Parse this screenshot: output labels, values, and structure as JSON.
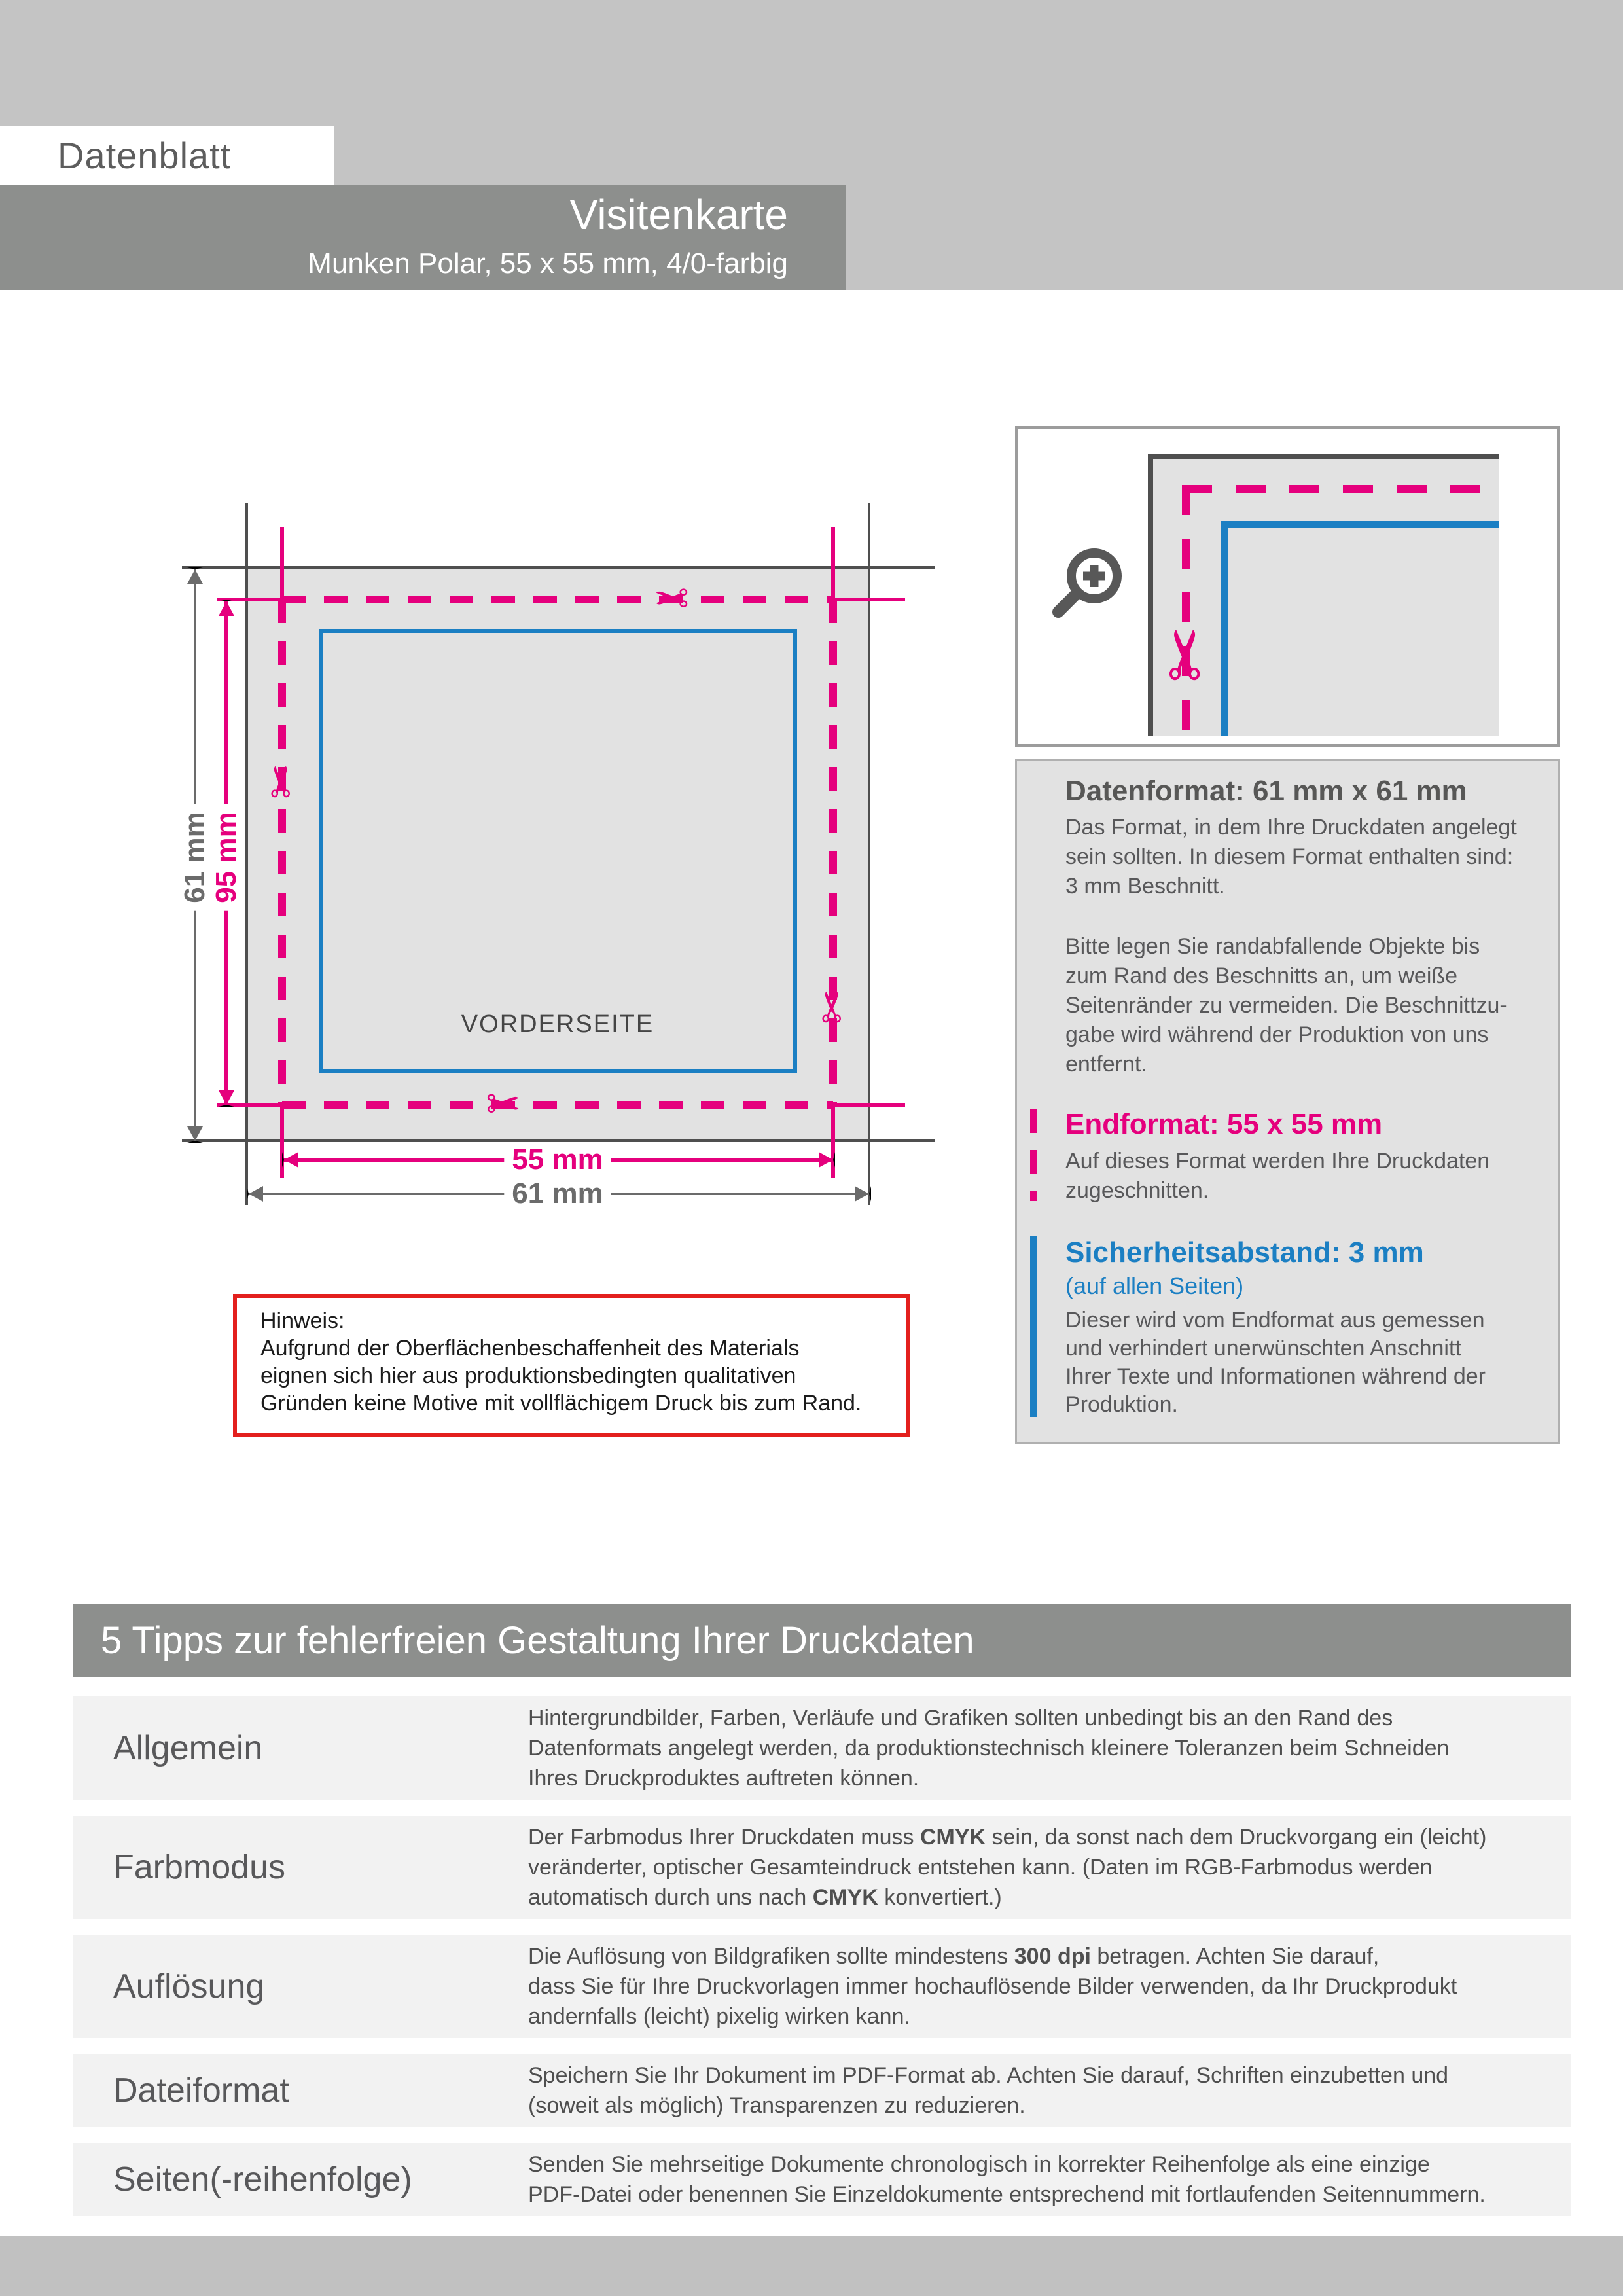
{
  "colors": {
    "magenta": "#e5007d",
    "blue": "#1b7fc3",
    "red": "#e3201d",
    "dark": "#575756",
    "band": "#8d8f8d",
    "light": "#c4c4c4",
    "fill": "#e2e2e2",
    "row": "#f2f2f2",
    "footer": "#c1c1c1",
    "cropline": "#4f4f4f"
  },
  "icons": {
    "scissors": "✂"
  },
  "header": {
    "tag": "Datenblatt",
    "product": "Visitenkarte",
    "specs": "Munken Polar, 55 x 55 mm, 4/0-farbig"
  },
  "diagram": {
    "front_label": "VORDERSEITE",
    "dim_outer_vertical": "61 mm",
    "dim_inner_vertical": "95 mm",
    "dim_inner_horizontal": "55 mm",
    "dim_outer_horizontal": "61 mm"
  },
  "panel": {
    "datenformat": {
      "heading": "Datenformat: 61 mm x 61 mm",
      "body1": "Das Format, in dem Ihre Druckdaten angelegt\nsein sollten. In diesem Format enthalten sind:\n3 mm Beschnitt.",
      "body2": "Bitte legen Sie randabfallende Objekte bis\nzum Rand des Beschnitts an, um weiße\nSeitenränder zu vermeiden. Die Beschnittzu-\ngabe wird während der Produktion von uns\nentfernt."
    },
    "endformat": {
      "heading": "Endformat: 55 x 55 mm",
      "body": "Auf dieses Format werden Ihre Druckdaten\nzugeschnitten."
    },
    "sicherheitsabstand": {
      "heading": "Sicherheitsabstand: 3 mm",
      "subheading": "(auf allen Seiten)",
      "body": "Dieser wird vom Endformat aus gemessen\nund verhindert unerwünschten Anschnitt\nIhrer Texte und Informationen während der\nProduktion."
    }
  },
  "hinweis": {
    "title": "Hinweis:",
    "body": "Aufgrund der Oberflächenbeschaffenheit des Materials\neignen sich hier aus produktionsbedingten qualitativen\nGründen keine Motive mit vollflächigem Druck bis zum Rand."
  },
  "tips": {
    "title": "5 Tipps zur fehlerfreien Gestaltung Ihrer Druckdaten",
    "rows": [
      {
        "label": "Allgemein",
        "text": "Hintergrundbilder, Farben, Verläufe und Grafiken sollten unbedingt bis an den Rand des\nDatenformats angelegt werden, da produktionstechnisch kleinere Toleranzen beim Schneiden\nIhres Druckproduktes auftreten können."
      },
      {
        "label": "Farbmodus",
        "s1": "Der Farbmodus Ihrer Druckdaten muss ",
        "b1": "CMYK",
        "s2": " sein, da sonst nach dem Druckvorgang ein (leicht)\nveränderter, optischer Gesamteindruck entstehen kann. (Daten im RGB-Farbmodus werden\nautomatisch durch uns nach ",
        "b2": "CMYK",
        "s3": " konvertiert.)"
      },
      {
        "label": "Auflösung",
        "s1": "Die Auflösung von Bildgrafiken sollte mindestens ",
        "b1": "300 dpi",
        "s2": " betragen. Achten Sie darauf,\ndass Sie für Ihre Druckvorlagen immer hochauflösende Bilder verwenden, da Ihr Druckprodukt\nandernfalls (leicht) pixelig wirken kann."
      },
      {
        "label": "Dateiformat",
        "text": "Speichern Sie Ihr Dokument im PDF-Format ab. Achten Sie darauf, Schriften einzubetten und\n(soweit als möglich) Transparenzen zu reduzieren."
      },
      {
        "label": "Seiten(-reihenfolge)",
        "text": "Senden Sie mehrseitige Dokumente chronologisch in korrekter Reihenfolge als eine einzige\nPDF-Datei oder benennen Sie Einzeldokumente entsprechend mit fortlaufenden Seitennummern."
      }
    ]
  }
}
